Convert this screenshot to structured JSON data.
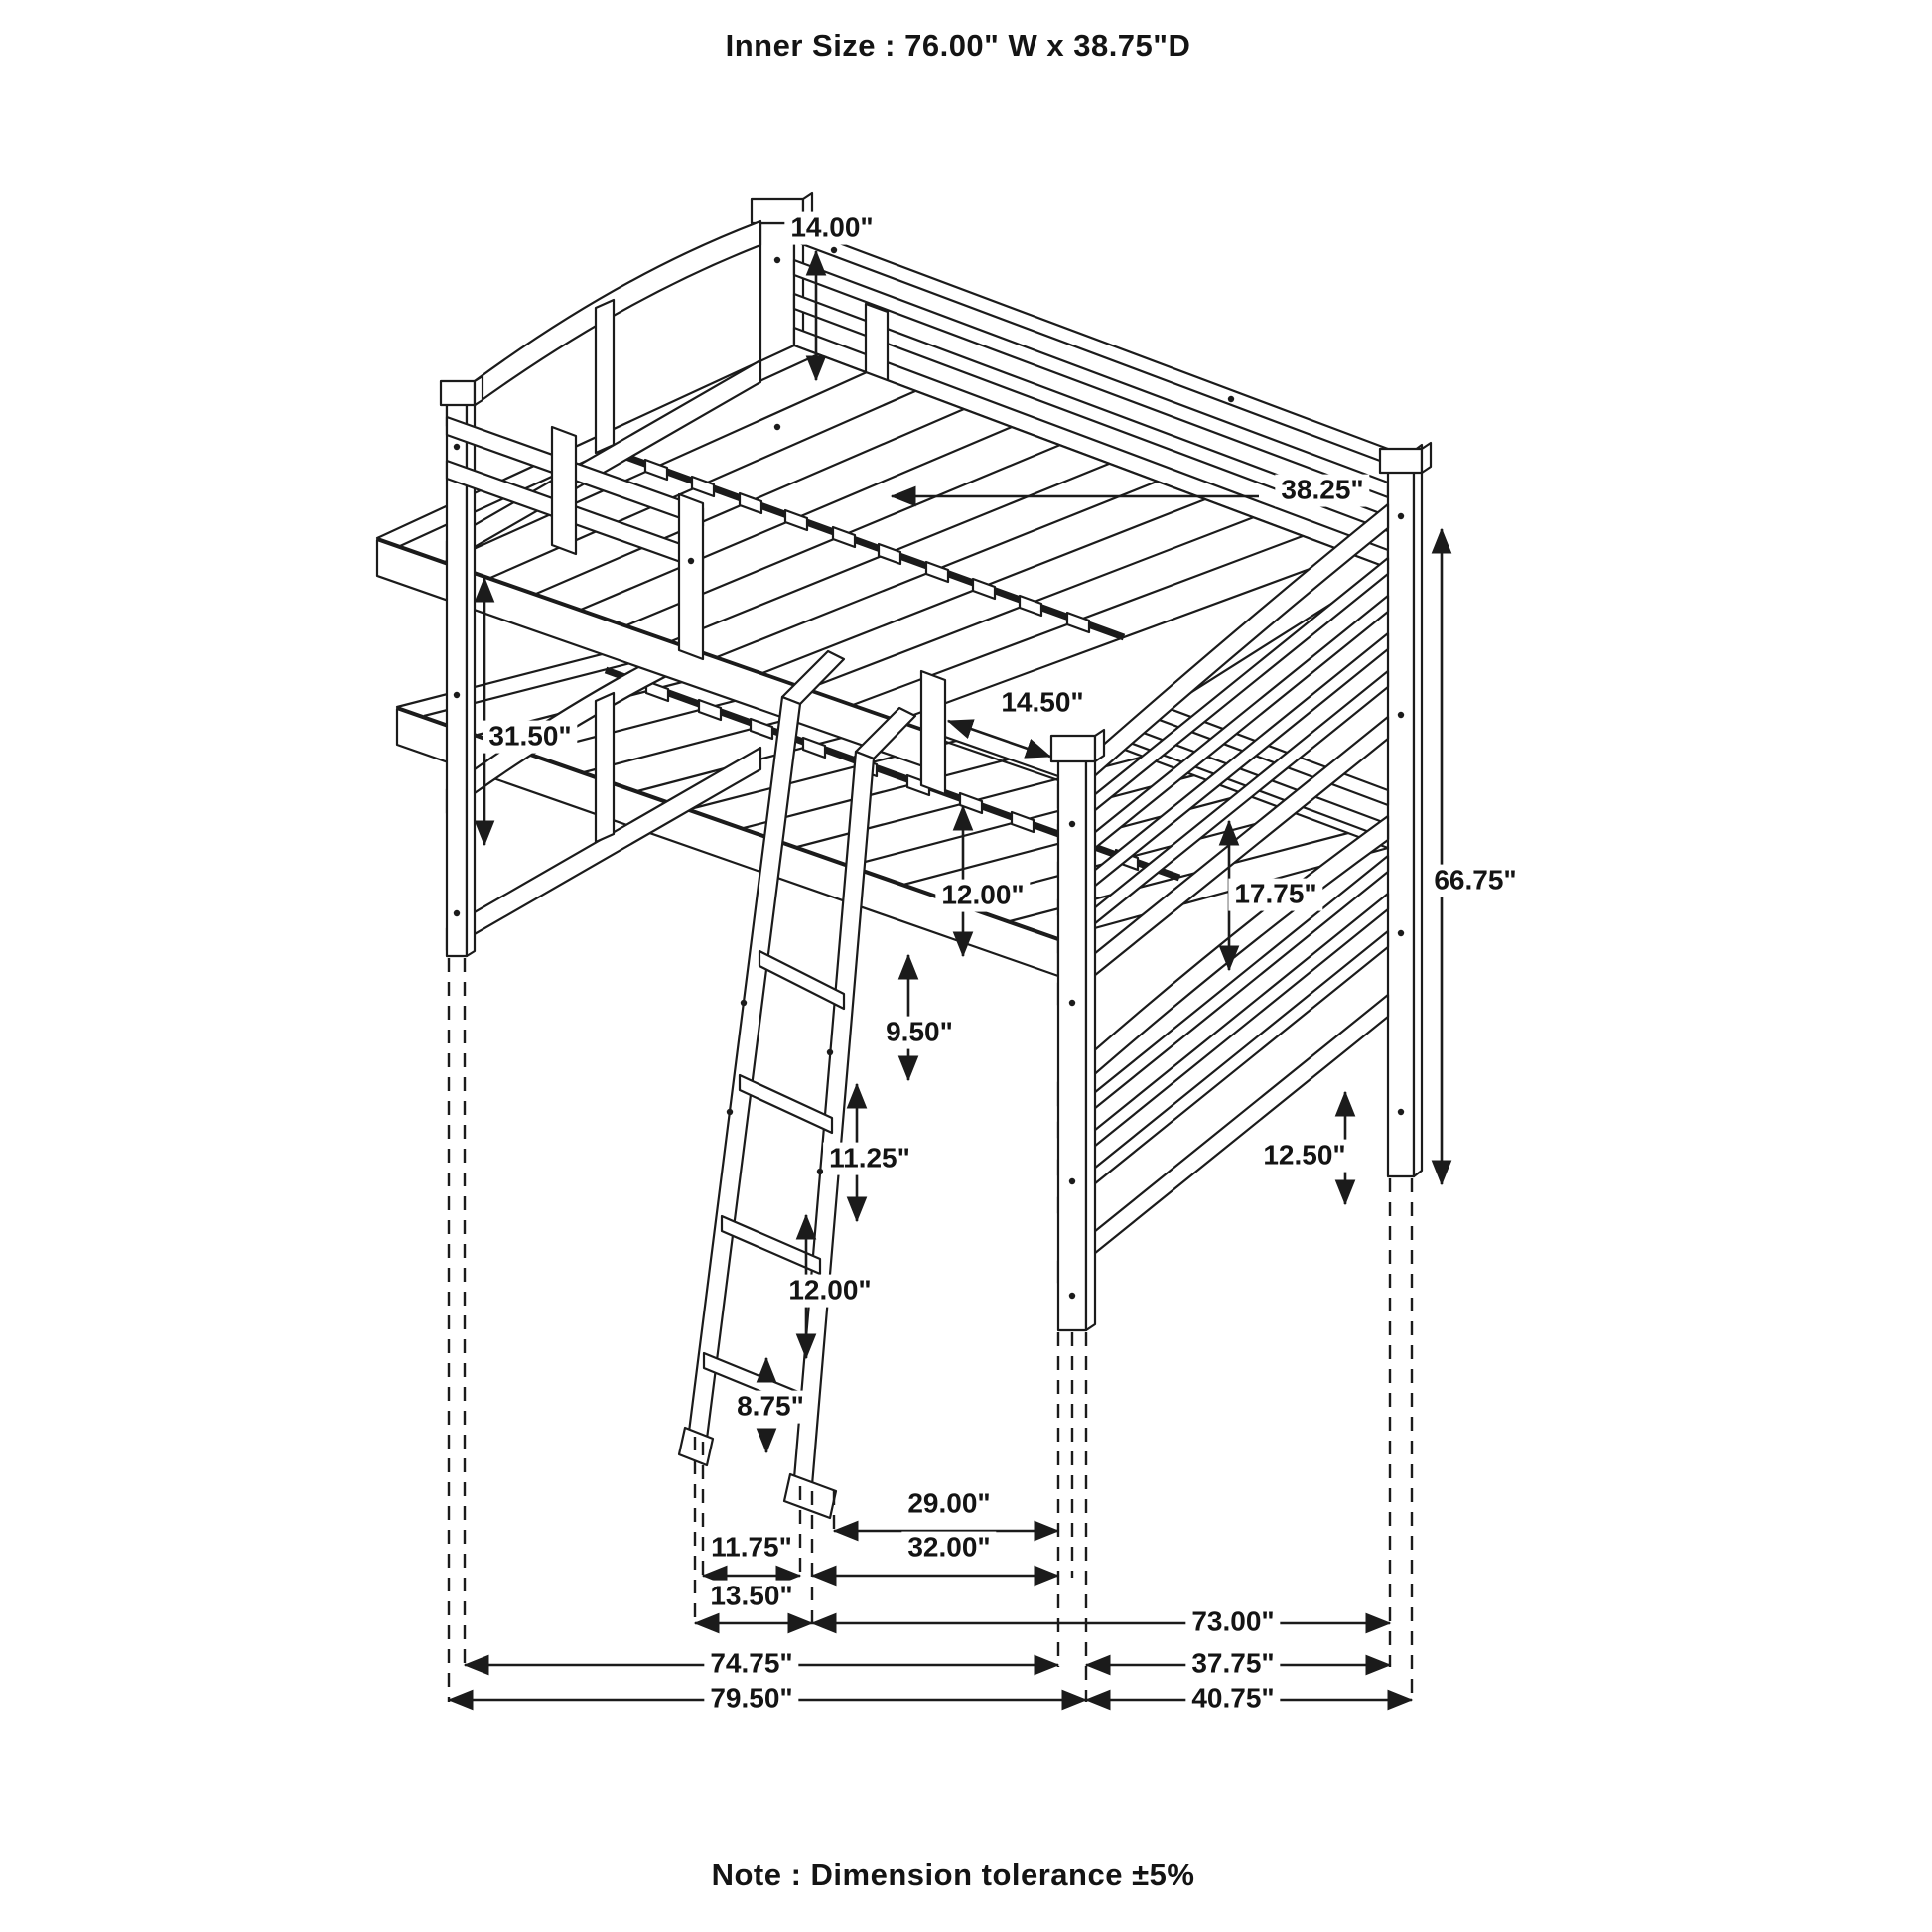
{
  "title": "Inner Size : 76.00\" W x  38.75\"D",
  "note": "Note : Dimension tolerance ±5%",
  "dims": {
    "rail_height": {
      "label": "14.00\""
    },
    "inner_depth": {
      "label": "38.25\""
    },
    "bunk_clearance": {
      "label": "31.50\""
    },
    "ladder_opening": {
      "label": "14.50\""
    },
    "step_top": {
      "label": "12.00\""
    },
    "foot_panel": {
      "label": "17.75\""
    },
    "step_2": {
      "label": "9.50\""
    },
    "overall_height": {
      "label": "66.75\""
    },
    "step_3": {
      "label": "11.25\""
    },
    "under_clearance": {
      "label": "12.50\""
    },
    "step_4": {
      "label": "12.00\""
    },
    "step_bottom": {
      "label": "8.75\""
    },
    "post_to_post": {
      "label": "29.00\""
    },
    "feet_inner": {
      "label": "11.75\""
    },
    "ladder_span": {
      "label": "32.00\""
    },
    "feet_outer": {
      "label": "13.50\""
    },
    "inner_length": {
      "label": "73.00\""
    },
    "frame_length": {
      "label": "74.75\""
    },
    "frame_width": {
      "label": "37.75\""
    },
    "overall_length": {
      "label": "79.50\""
    },
    "overall_width": {
      "label": "40.75\""
    }
  },
  "colors": {
    "line": "#1b1b1b",
    "background": "#ffffff"
  }
}
